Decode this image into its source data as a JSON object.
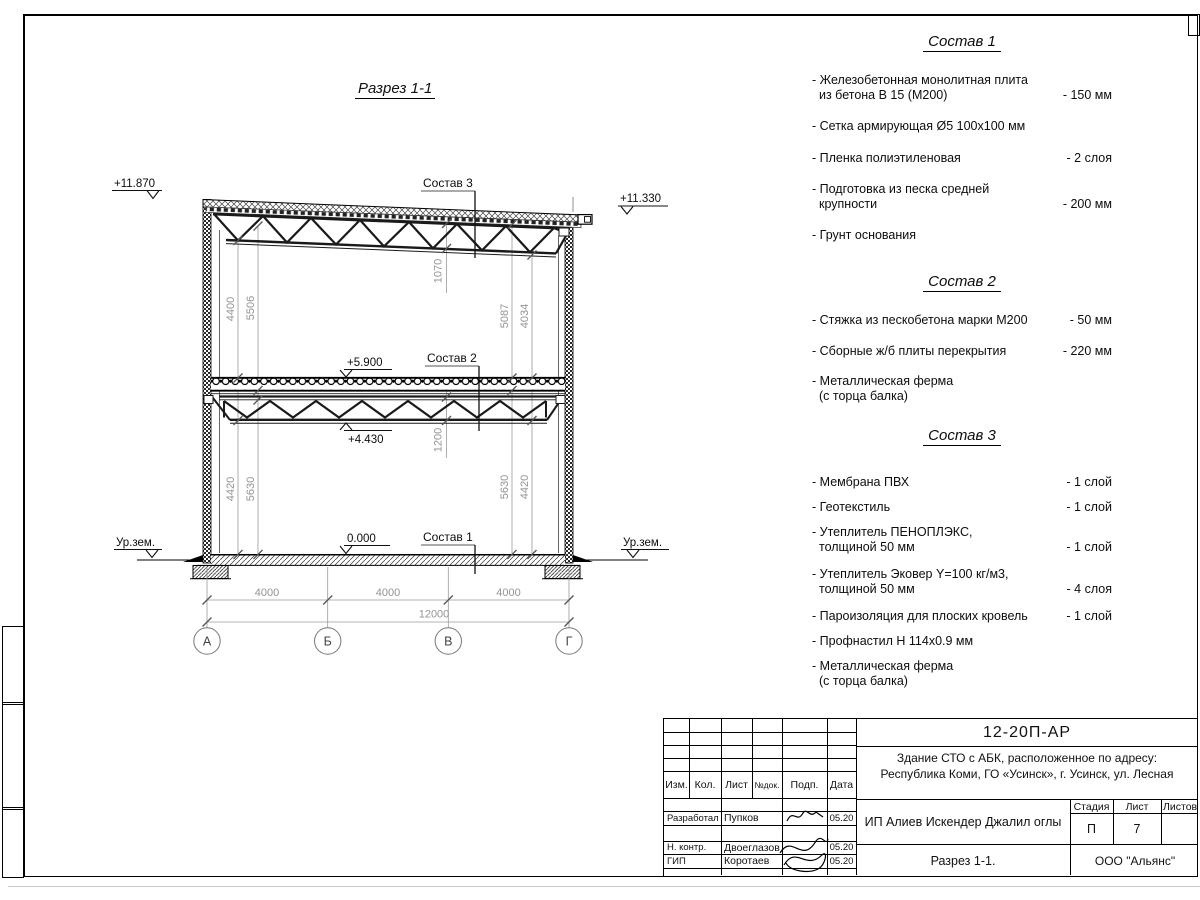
{
  "drawing": {
    "title": "Разрез 1-1",
    "elevations": {
      "roof_left": "+11.870",
      "roof_right": "+11.330",
      "floor2": "+5.900",
      "truss_bottom": "+4.430",
      "floor1": "0.000"
    },
    "ground_level_left": "Ур.зем.",
    "ground_level_right": "Ур.зем.",
    "callouts": {
      "c1": "Состав 1",
      "c2": "Состав 2",
      "c3": "Состав 3"
    },
    "dims": {
      "left_top_inner": "4400",
      "left_top_outer": "5506",
      "right_top_inner": "5087",
      "right_top_outer": "4034",
      "left_bot_inner": "4420",
      "left_bot_outer": "5630",
      "right_bot_inner": "5630",
      "right_bot_outer": "4420",
      "roof_truss_depth": "1070",
      "floor_truss_depth": "1200",
      "span_ab": "4000",
      "span_bv": "4000",
      "span_vg": "4000",
      "span_total": "12000"
    },
    "axes": [
      "А",
      "Б",
      "В",
      "Г"
    ]
  },
  "compositions": [
    {
      "title": "Состав 1",
      "items": [
        {
          "lines": [
            "- Железобетонная  монолитная плита",
            "из бетона В 15 (М200)"
          ],
          "value": "- 150 мм"
        },
        {
          "lines": [
            "- Сетка армирующая Ø5 100х100 мм"
          ],
          "value": ""
        },
        {
          "lines": [
            "- Пленка полиэтиленовая"
          ],
          "value": "-  2 слоя"
        },
        {
          "lines": [
            "- Подготовка из песка средней",
            "крупности"
          ],
          "value": "- 200 мм"
        },
        {
          "lines": [
            "- Грунт основания"
          ],
          "value": ""
        }
      ]
    },
    {
      "title": "Состав 2",
      "items": [
        {
          "lines": [
            "- Стяжка из пескобетона марки М200"
          ],
          "value": "- 50 мм"
        },
        {
          "lines": [
            "- Сборные ж/б плиты перекрытия"
          ],
          "value": "- 220 мм"
        },
        {
          "lines": [
            "- Металлическая ферма",
            "(с торца балка)"
          ],
          "value": ""
        }
      ]
    },
    {
      "title": "Состав 3",
      "items": [
        {
          "lines": [
            "- Мембрана ПВХ"
          ],
          "value": "- 1 слой"
        },
        {
          "lines": [
            "- Геотекстиль"
          ],
          "value": "- 1 слой"
        },
        {
          "lines": [
            "- Утеплитель ПЕНОПЛЭКС,",
            "толщиной 50 мм"
          ],
          "value": "- 1 слой"
        },
        {
          "lines": [
            "- Утеплитель Эковер Y=100 кг/м3,",
            "толщиной 50 мм"
          ],
          "value": "- 4 слоя"
        },
        {
          "lines": [
            "- Пароизоляция для плоских кровель"
          ],
          "value": "- 1 слой"
        },
        {
          "lines": [
            "- Профнастил Н 114х0.9 мм"
          ],
          "value": ""
        },
        {
          "lines": [
            "- Металлическая ферма",
            "(с торца балка)"
          ],
          "value": ""
        }
      ]
    }
  ],
  "titleblock": {
    "doc_number": "12-20П-АР",
    "project_line1": "Здание СТО с АБК, расположенное по адресу:",
    "project_line2": "Республика Коми, ГО «Усинск», г. Усинск, ул. Лесная",
    "header": {
      "izm": "Изм.",
      "kol": "Кол.",
      "list": "Лист",
      "ndok": "№док.",
      "podp": "Подп.",
      "data": "Дата"
    },
    "client": "ИП Алиев Искендер Джалил оглы",
    "sheet_title": "Разрез 1-1.",
    "company": "ООО \"Альянс\"",
    "stage_label": "Стадия",
    "sheet_label": "Лист",
    "sheets_label": "Листов",
    "stage_value": "П",
    "sheet_value": "7",
    "roles": [
      {
        "role": "Разработал",
        "name": "Пупков",
        "date": "05.20"
      },
      {
        "role": "Н. контр.",
        "name": "Двоеглазов",
        "date": "05.20"
      },
      {
        "role": "ГИП",
        "name": "Коротаев",
        "date": "05.20"
      }
    ]
  }
}
